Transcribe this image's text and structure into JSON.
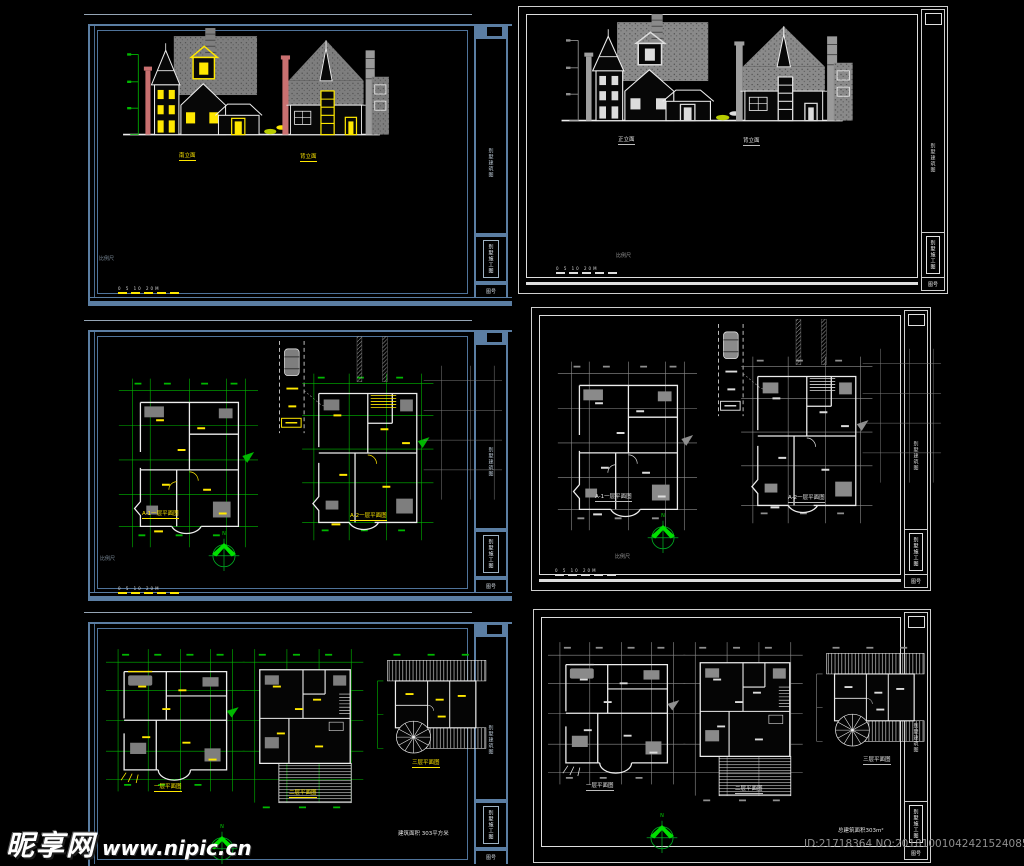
{
  "watermark": {
    "logo": "昵享网",
    "site": "www.nipic.cn"
  },
  "stamp": {
    "id_no": "ID:21718364 NO:20181001042421524085"
  },
  "common": {
    "north": "N",
    "scale_label": "比例尺",
    "scale_ticks": "0 5 10 20M",
    "titleblock": {
      "top": "别墅建筑图",
      "box": "别墅施工图",
      "cell": "图号"
    }
  },
  "sheets": {
    "l1": {
      "labels": {
        "a": "南立面",
        "b": "背立面"
      }
    },
    "r1": {
      "labels": {
        "a": "正立面",
        "b": "背立面"
      }
    },
    "l2": {
      "labels": {
        "a": "A-1一层平面图",
        "b": "A-2一层平面图"
      }
    },
    "r2": {
      "labels": {
        "a": "A-1一层平面图",
        "b": "A-2一层平面图"
      }
    },
    "l3": {
      "labels": {
        "f1": "一层平面图",
        "f2": "二层平面图",
        "f3": "三层平面图"
      },
      "area_note": "建筑面积 303平方米"
    },
    "r3": {
      "labels": {
        "f1": "一层平面图",
        "f2": "二层平面图",
        "f3": "三层平面图"
      },
      "area_note": "总建筑面积303m²"
    }
  },
  "colors": {
    "frame_blue": "#5b7ea3",
    "frame_white": "#d6d6d6",
    "dim_green": "#00b800",
    "accent_yellow": "#ffe800",
    "compass_green": "#00cc00",
    "wall_white": "#ededed",
    "stamp_gray": "#8f8f8f",
    "background": "#000000"
  }
}
